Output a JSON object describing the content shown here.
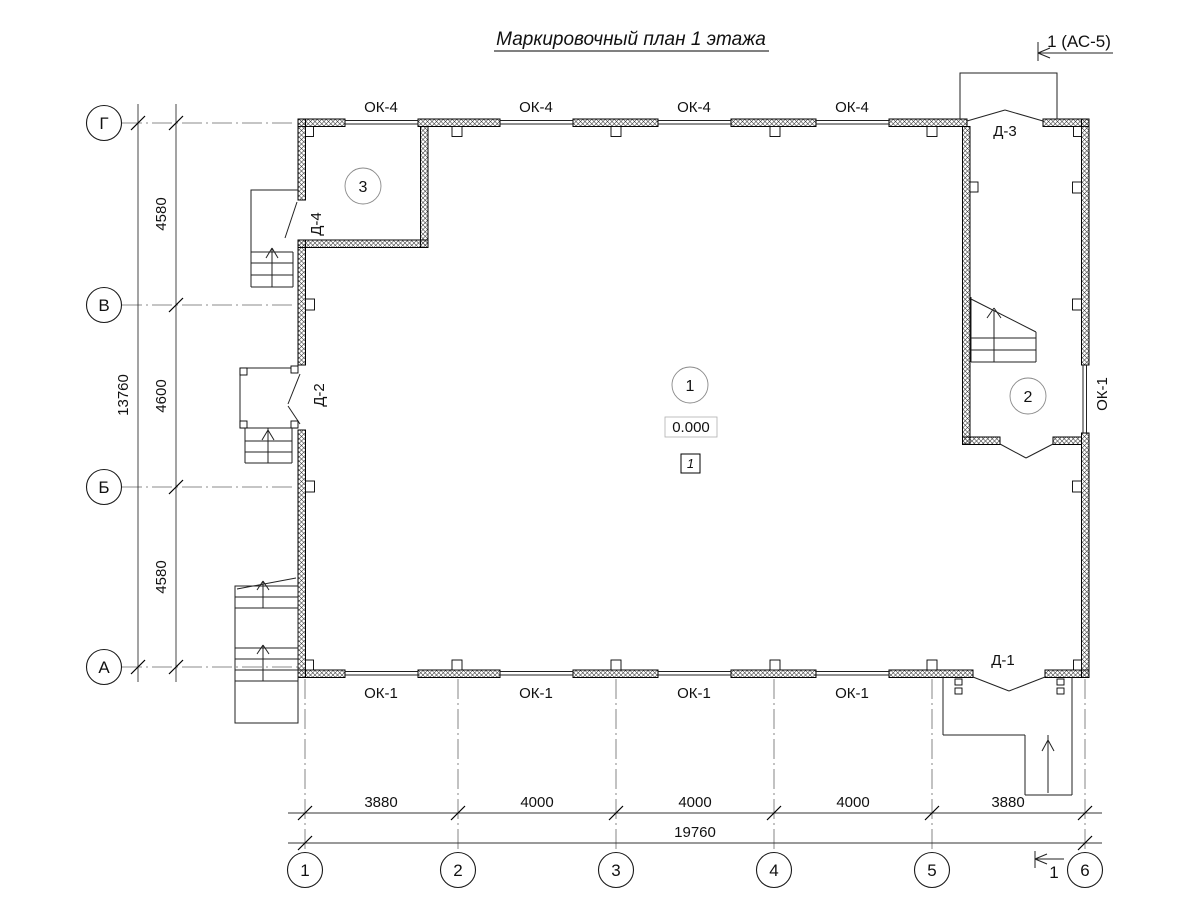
{
  "title": "Маркировочный план 1 этажа",
  "marks": {
    "section_top": "1 (АС-5)",
    "section_bottom": "1",
    "elevation": "0.000",
    "floor_mark": "1"
  },
  "axes": {
    "horizontal": [
      {
        "label": "Г"
      },
      {
        "label": "В"
      },
      {
        "label": "Б"
      },
      {
        "label": "А"
      }
    ],
    "vertical": [
      {
        "label": "1"
      },
      {
        "label": "2"
      },
      {
        "label": "3"
      },
      {
        "label": "4"
      },
      {
        "label": "5"
      },
      {
        "label": "6"
      }
    ]
  },
  "dims": {
    "left_segments": [
      "4580",
      "4600",
      "4580"
    ],
    "left_total": "13760",
    "bottom_segments": [
      "3880",
      "4000",
      "4000",
      "4000",
      "3880"
    ],
    "bottom_total": "19760"
  },
  "windows": {
    "top_labels": [
      "ОК-4",
      "ОК-4",
      "ОК-4",
      "ОК-4"
    ],
    "bottom_labels": [
      "ОК-1",
      "ОК-1",
      "ОК-1",
      "ОК-1"
    ],
    "right_label": "ОК-1"
  },
  "doors": {
    "d1": "Д-1",
    "d2": "Д-2",
    "d3": "Д-3",
    "d4": "Д-4"
  },
  "rooms": {
    "r1": "1",
    "r2": "2",
    "r3": "3"
  }
}
